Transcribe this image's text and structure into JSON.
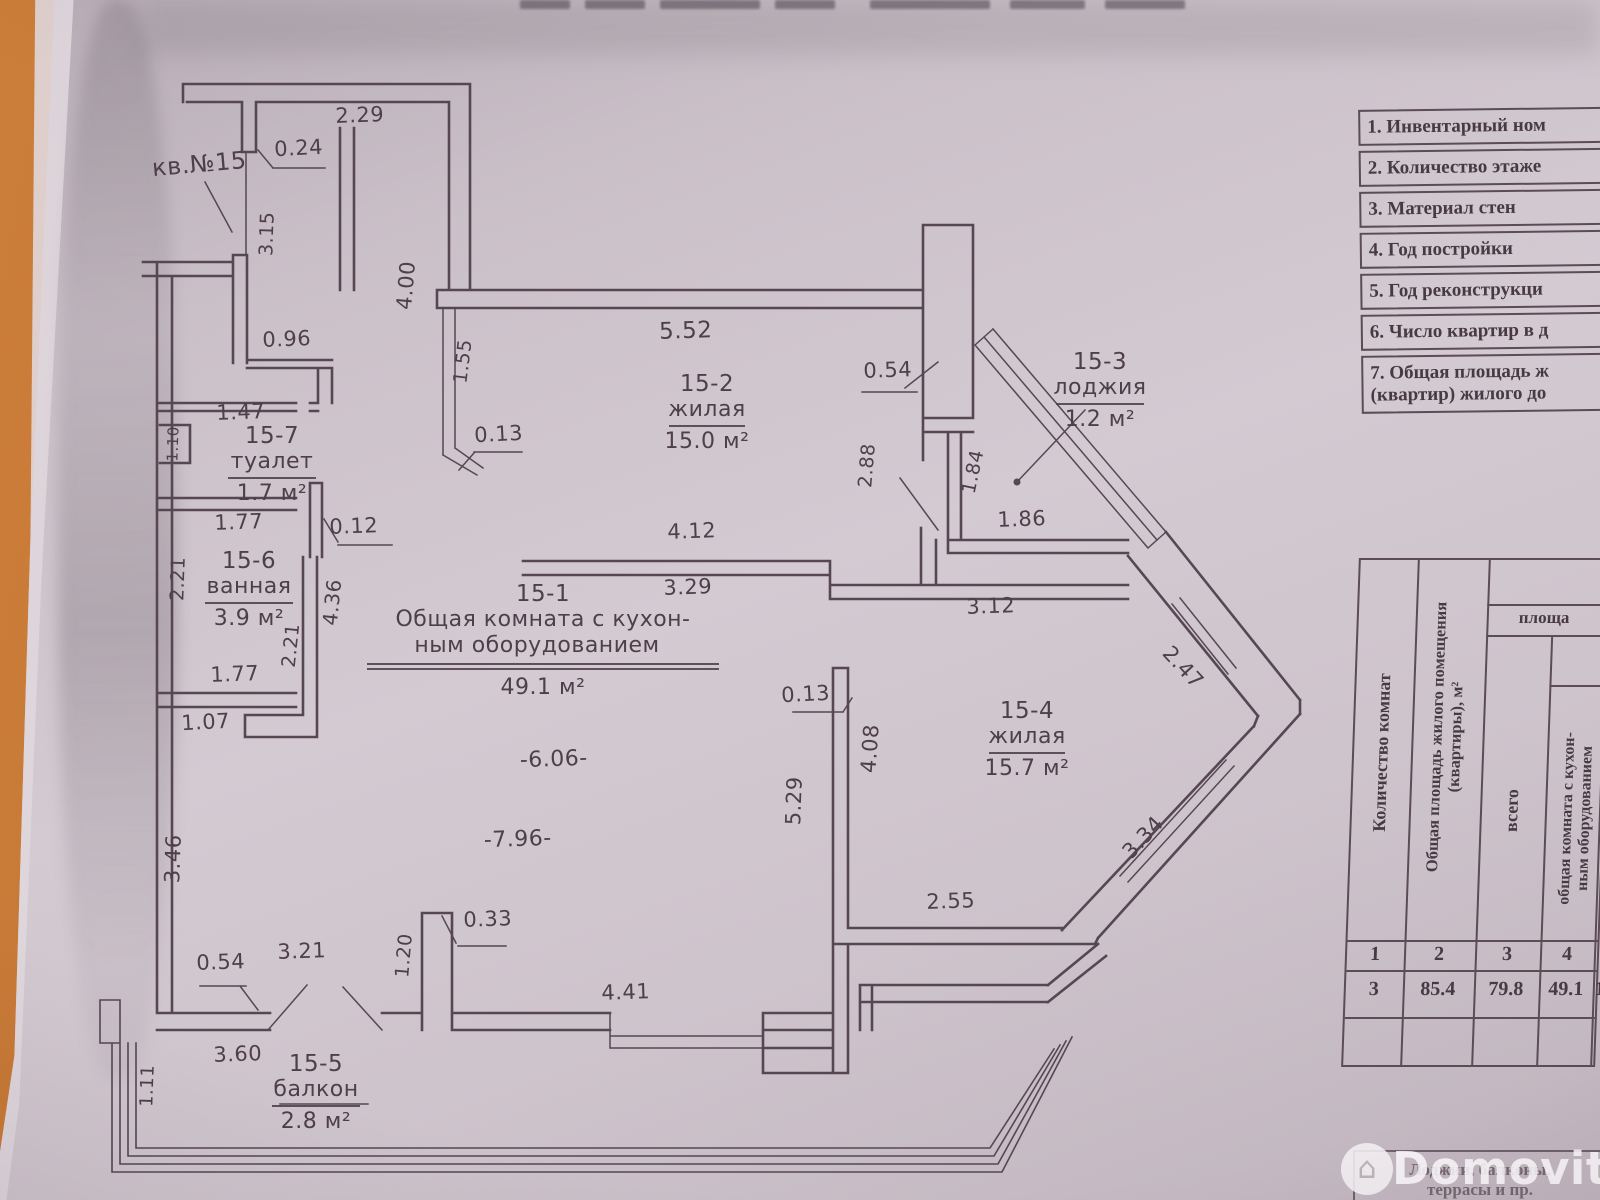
{
  "plan": {
    "apartment_label": "кв.№15",
    "rooms": [
      {
        "id": "15-2",
        "name": "жилая",
        "area": "15.0 м²",
        "x": 707,
        "y": 391
      },
      {
        "id": "15-3",
        "name": "лоджия",
        "area": "1.2 м²",
        "x": 1100,
        "y": 369
      },
      {
        "id": "15-7",
        "name": "туалет",
        "area": "1.7 м²",
        "x": 272,
        "y": 443
      },
      {
        "id": "15-6",
        "name": "ванная",
        "area": "3.9 м²",
        "x": 249,
        "y": 568
      },
      {
        "id": "15-1",
        "name": "Общая комната с кухон-",
        "name2": "ным оборудованием",
        "area": "49.1 м²",
        "x": 543,
        "y": 601
      },
      {
        "id": "15-4",
        "name": "жилая",
        "area": "15.7 м²",
        "x": 1027,
        "y": 718
      },
      {
        "id": "15-5",
        "name": "балкон",
        "area": "2.8 м²",
        "x": 316,
        "y": 1071
      }
    ],
    "dimensions": [
      {
        "t": "кв.№15",
        "x": 200,
        "y": 172,
        "r": -5,
        "fs": 24
      },
      {
        "t": "2.29",
        "x": 360,
        "y": 122,
        "r": -2
      },
      {
        "t": "0.24",
        "x": 299,
        "y": 155,
        "r": -3
      },
      {
        "t": "3.15",
        "x": 273,
        "y": 234,
        "r": -88,
        "fs": 19
      },
      {
        "t": "4.00",
        "x": 413,
        "y": 286,
        "r": -85
      },
      {
        "t": "0.96",
        "x": 287,
        "y": 346,
        "r": -2
      },
      {
        "t": "1.55",
        "x": 469,
        "y": 362,
        "r": -83,
        "fs": 19
      },
      {
        "t": "5.52",
        "x": 686,
        "y": 338,
        "r": -2,
        "fs": 23
      },
      {
        "t": "0.13",
        "x": 499,
        "y": 441,
        "r": -3
      },
      {
        "t": "1.47",
        "x": 241,
        "y": 419,
        "r": -2
      },
      {
        "t": "1.10",
        "x": 178,
        "y": 444,
        "r": -88,
        "fs": 15
      },
      {
        "t": "1.77",
        "x": 239,
        "y": 529,
        "r": -2
      },
      {
        "t": "0.12",
        "x": 354,
        "y": 533,
        "r": -2
      },
      {
        "t": "2.21",
        "x": 184,
        "y": 579,
        "r": -88,
        "fs": 19
      },
      {
        "t": "4.36",
        "x": 339,
        "y": 603,
        "r": -84,
        "fs": 20
      },
      {
        "t": "2.21",
        "x": 297,
        "y": 646,
        "r": -84,
        "fs": 19
      },
      {
        "t": "1.77",
        "x": 235,
        "y": 681,
        "r": -2
      },
      {
        "t": "1.07",
        "x": 206,
        "y": 729,
        "r": -3
      },
      {
        "t": "3.46",
        "x": 180,
        "y": 859,
        "r": -88
      },
      {
        "t": "0.54",
        "x": 888,
        "y": 377,
        "r": -2
      },
      {
        "t": "2.88",
        "x": 873,
        "y": 466,
        "r": -85,
        "fs": 19
      },
      {
        "t": "1.84",
        "x": 979,
        "y": 473,
        "r": -78,
        "fs": 19
      },
      {
        "t": "4.12",
        "x": 692,
        "y": 538,
        "r": -2
      },
      {
        "t": "3.29",
        "x": 688,
        "y": 594,
        "r": -2
      },
      {
        "t": "1.86",
        "x": 1022,
        "y": 526,
        "r": -2
      },
      {
        "t": "3.12",
        "x": 991,
        "y": 613,
        "r": -2
      },
      {
        "t": "-6.06-",
        "x": 554,
        "y": 766,
        "r": -2,
        "fs": 22
      },
      {
        "t": "-7.96-",
        "x": 518,
        "y": 846,
        "r": -2,
        "fs": 22
      },
      {
        "t": "2.47",
        "x": 1178,
        "y": 672,
        "r": 47
      },
      {
        "t": "3.34",
        "x": 1148,
        "y": 842,
        "r": -47
      },
      {
        "t": "0.13",
        "x": 806,
        "y": 701,
        "r": -3
      },
      {
        "t": "4.08",
        "x": 877,
        "y": 749,
        "r": -86
      },
      {
        "t": "5.29",
        "x": 801,
        "y": 801,
        "r": -88
      },
      {
        "t": "2.55",
        "x": 951,
        "y": 908,
        "r": -2
      },
      {
        "t": "0.33",
        "x": 488,
        "y": 926,
        "r": -2
      },
      {
        "t": "1.20",
        "x": 410,
        "y": 956,
        "r": -85,
        "fs": 19
      },
      {
        "t": "0.54",
        "x": 221,
        "y": 969,
        "r": -2
      },
      {
        "t": "3.21",
        "x": 302,
        "y": 958,
        "r": -2
      },
      {
        "t": "4.41",
        "x": 626,
        "y": 999,
        "r": -2
      },
      {
        "t": "3.60",
        "x": 238,
        "y": 1061,
        "r": -2
      },
      {
        "t": "1.11",
        "x": 153,
        "y": 1086,
        "r": -88,
        "fs": 18
      }
    ]
  },
  "info_table": {
    "rows": [
      "1. Инвентарный ном",
      "2. Количество этаже",
      "3. Материал стен",
      "4. Год постройки",
      "5. Год реконструкци",
      "6. Число квартир в д",
      "7. Общая площадь ж"
    ],
    "row7_line2": "(квартир) жилого до"
  },
  "area_table": {
    "col1_header": "Количество комнат",
    "col2_header": "Общая площадь жилого помещения (квартиры), м²",
    "span_header": "площа",
    "col3_header": "всего",
    "col4_header_line1": "общая комната с кухон-",
    "col4_header_line2": "ным оборудованием",
    "col_numbers": [
      "1",
      "2",
      "3",
      "4"
    ],
    "values": [
      "3",
      "85.4",
      "79.8",
      "49.1"
    ],
    "next_col_cut": "1",
    "footer_note_line1": "Лоджии, балконы,",
    "footer_note_line2": "террасы и пр."
  },
  "watermark": {
    "brand": "Domovita"
  }
}
